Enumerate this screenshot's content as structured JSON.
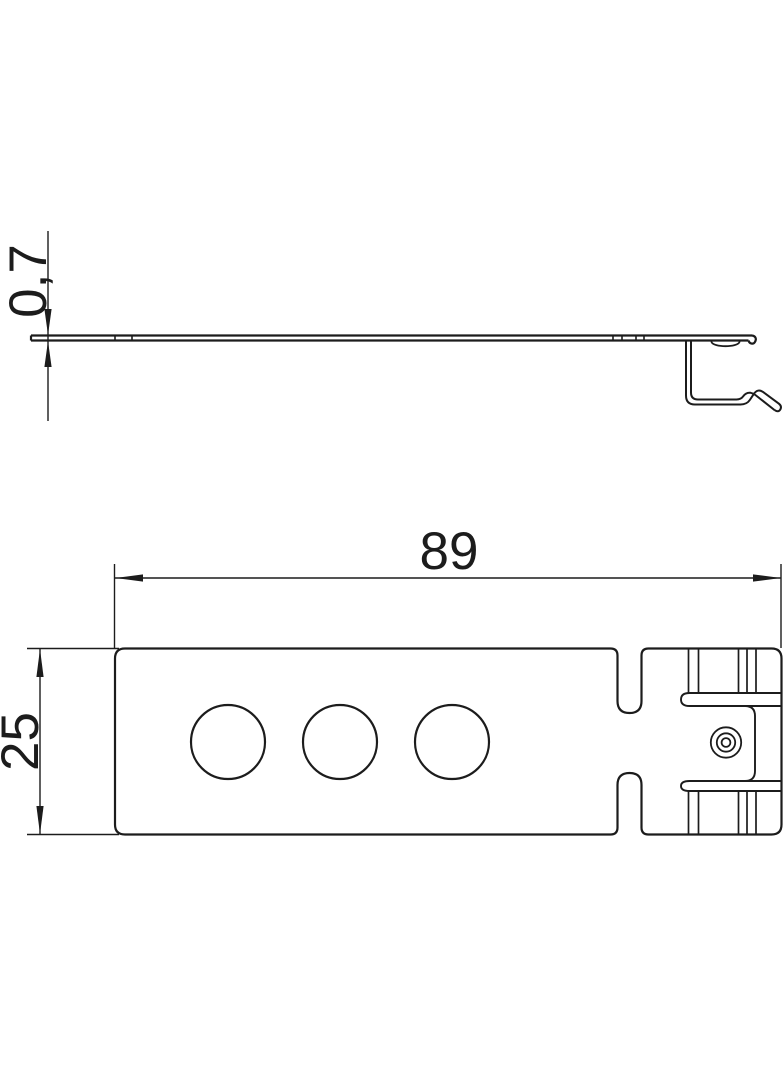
{
  "drawing": {
    "type": "technical-drawing",
    "background": "#ffffff",
    "line_color": "#1c1c1c",
    "views": {
      "side_view": "thin plate profile with bent spring clip and rivet dome",
      "plan_view": "rectangular cover plate, 3 round holes, two slots, clip tab with rivet"
    },
    "dimensions": {
      "thickness": "0,7",
      "length": "89",
      "width": "25"
    }
  }
}
